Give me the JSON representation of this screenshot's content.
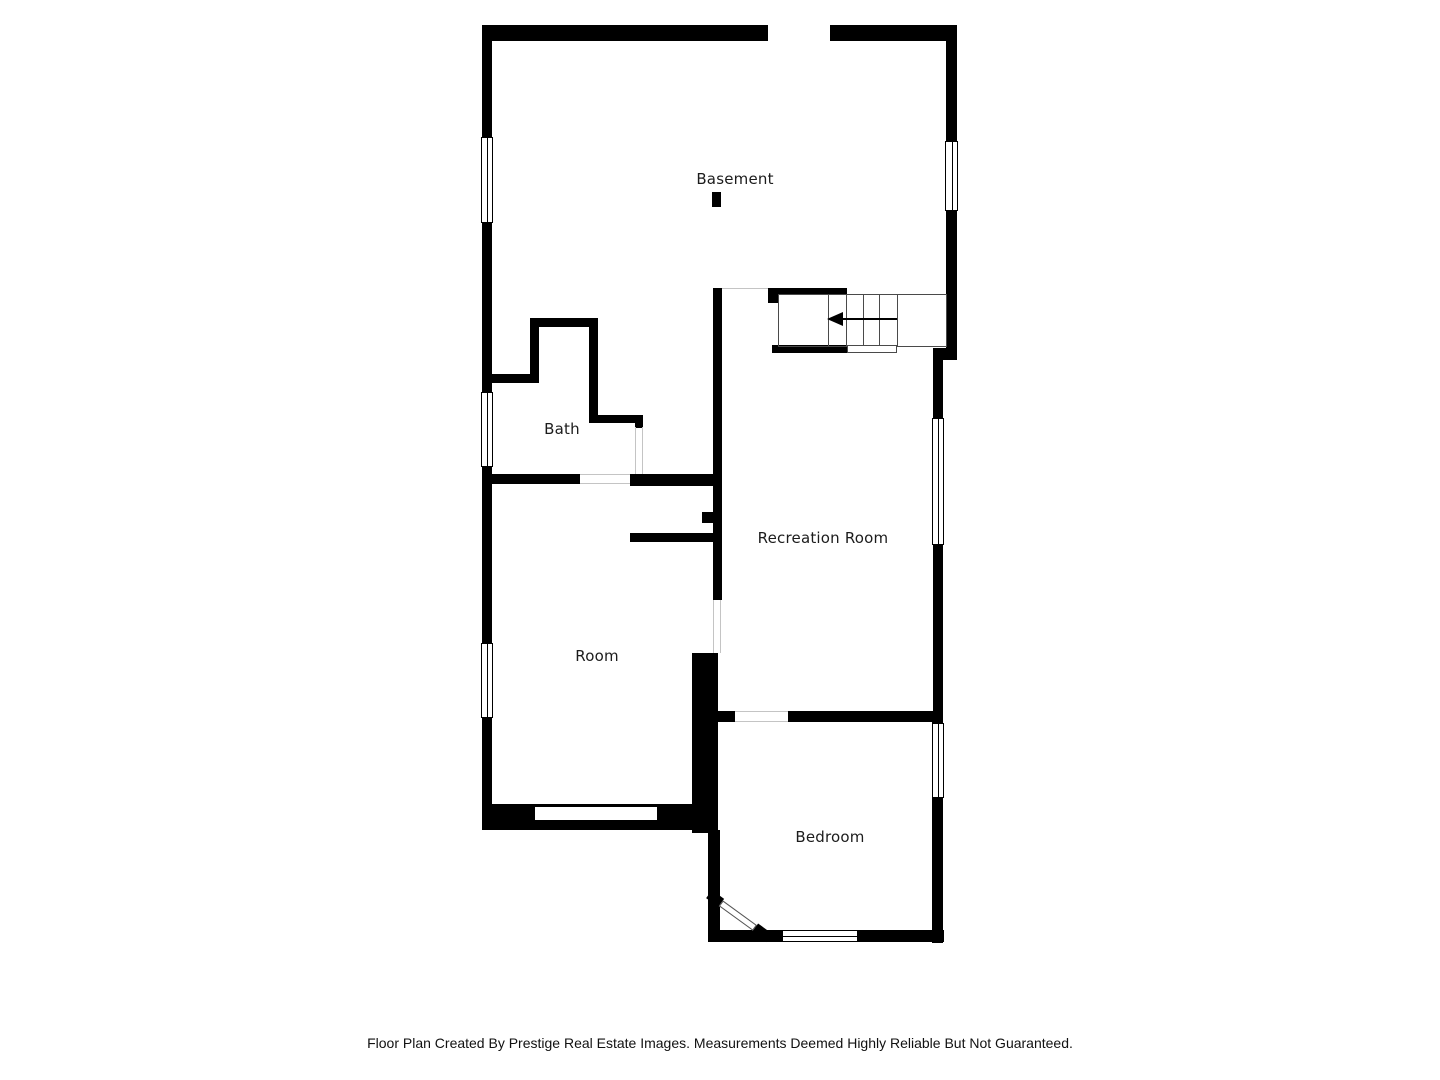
{
  "plan": {
    "title": "Basement floor plan",
    "rooms": [
      {
        "label": "Basement"
      },
      {
        "label": "Bath"
      },
      {
        "label": "Room"
      },
      {
        "label": "Recreation Room"
      },
      {
        "label": "Bedroom"
      }
    ]
  },
  "icons": [
    {
      "name": "stairs-direction-arrow",
      "points": "left"
    }
  ],
  "colors": {
    "background": "#ffffff",
    "wall": "#000000",
    "door_opening_line": "#c4c4c4",
    "stair_line": "#4a4a4a",
    "label_text": "#1c1c1c"
  },
  "footer": {
    "disclaimer": "Floor Plan Created By Prestige Real Estate Images. Measurements Deemed Highly Reliable But Not Guaranteed."
  }
}
